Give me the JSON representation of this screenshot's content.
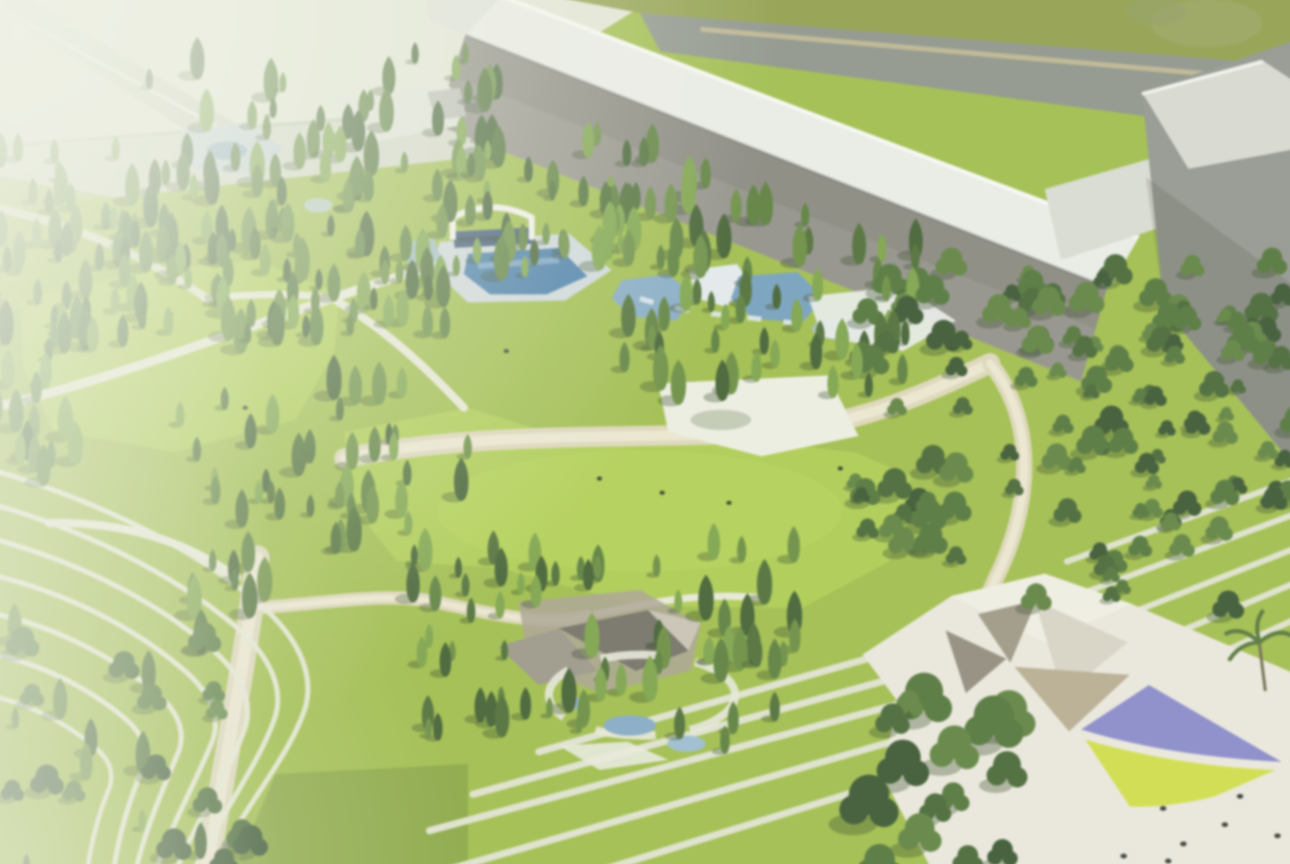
{
  "scene": {
    "kind": "aerial-architectural-rendering",
    "description": "Blurry aerial rendering of a landscaped park: dense conifer forests and bright meadows, a white bandshell with blue pools and a stream, winding white paths, terraced lawns with curved white contour lines at lower left, striped lawn fields, long gray warehouse buildings with white roofs along the top edge, an olive field and dark road behind them, and a white plaza at lower right with faceted tan canopies, a purple sail and a yellow-green sail, dotted with tiny people."
  },
  "palette": {
    "lawn-base": "#9cbb43",
    "meadow-green": "#aacb49",
    "olive-field": "#8e9d45",
    "road-dark": "#8a9187",
    "road-pale": "#d2d7c7",
    "roof-white": "#eaece8",
    "wall-gray": "#8e8d86",
    "path-white": "#e7e8d6",
    "path-beige": "#dcd6b8",
    "terrace-line": "#e5e8d6",
    "stripe-line": "#dde2cc",
    "water-deep": "#3d77a8",
    "water-mid": "#7ea7c6",
    "water-light": "#c2d0d8",
    "plaza-white": "#eae8dc",
    "canopy-tan": "#b5aa8e",
    "canopy-pale": "#d7d3c5",
    "purple-sail": "#8486cc",
    "yellow-sail": "#cedd3f",
    "haze": "#f1f4e9",
    "tree-conifer-colors": [
      "#3a5a2a",
      "#47692f",
      "#547a34",
      "#63893a",
      "#76a041"
    ],
    "tree-deciduous-colors": [
      "#32502a",
      "#3f612e",
      "#4b7033",
      "#587e38"
    ]
  }
}
